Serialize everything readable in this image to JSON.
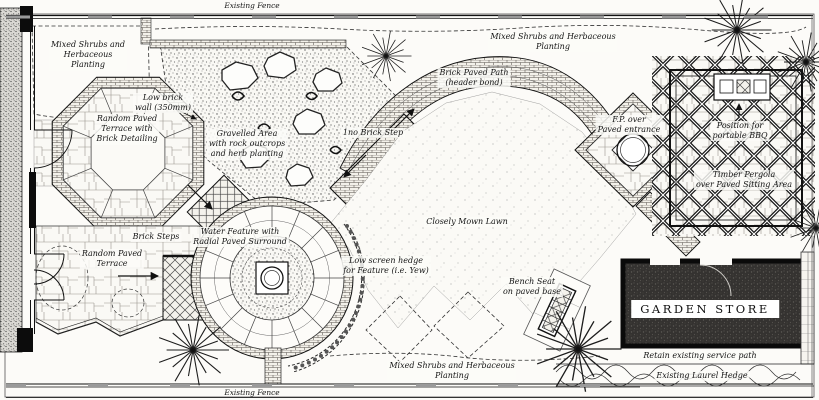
{
  "drawing": {
    "type": "garden landscape plan",
    "colors": {
      "paper": "#fcfbf8",
      "ink": "#1a1a1a",
      "store_fill": "#343230",
      "texture_gray": "#dbd9d4"
    },
    "symbols": [
      "tree-symbol",
      "door-swing",
      "direction-arrow",
      "water-feature",
      "bench-seat",
      "bbq-unit",
      "pergola-lattice",
      "rock-outcrop"
    ]
  },
  "labels": {
    "fence_top": "Existing Fence",
    "fence_bottom": "Existing Fence",
    "shrubs_tl": [
      "Mixed Shrubs and",
      "Herbaceous",
      "Planting"
    ],
    "shrubs_top": [
      "Mixed Shrubs and Herbaceous",
      "Planting"
    ],
    "shrubs_bottom": [
      "Mixed Shrubs and Herbaceous",
      "Planting"
    ],
    "low_wall": [
      "Low brick",
      "wall (350mm)"
    ],
    "terrace_oct": [
      "Random Paved",
      "Terrace with",
      "Brick Detailing"
    ],
    "terrace_lower": [
      "Random Paved",
      "Terrace"
    ],
    "gravel": [
      "Gravelled Area",
      "with rock outcrops",
      "and herb planting"
    ],
    "steps": "Brick Steps",
    "water": [
      "Water Feature with",
      "Radial Paved Surround"
    ],
    "hedge_screen": [
      "Low screen hedge",
      "for Feature (i.e. Yew)"
    ],
    "step1": "1no Brick Step",
    "path": [
      "Brick Paved Path",
      "(header bond)"
    ],
    "lawn": "Closely Mown Lawn",
    "fp": [
      "F.P. over",
      "Paved entrance"
    ],
    "bbq": [
      "Position for",
      "portable BBQ"
    ],
    "pergola": [
      "Timber Pergola",
      "over Paved Sitting Area"
    ],
    "bench": [
      "Bench Seat",
      "on paved base"
    ],
    "store": "GARDEN STORE",
    "service_path": "Retain existing service path",
    "laurel": "Existing Laurel Hedge"
  }
}
